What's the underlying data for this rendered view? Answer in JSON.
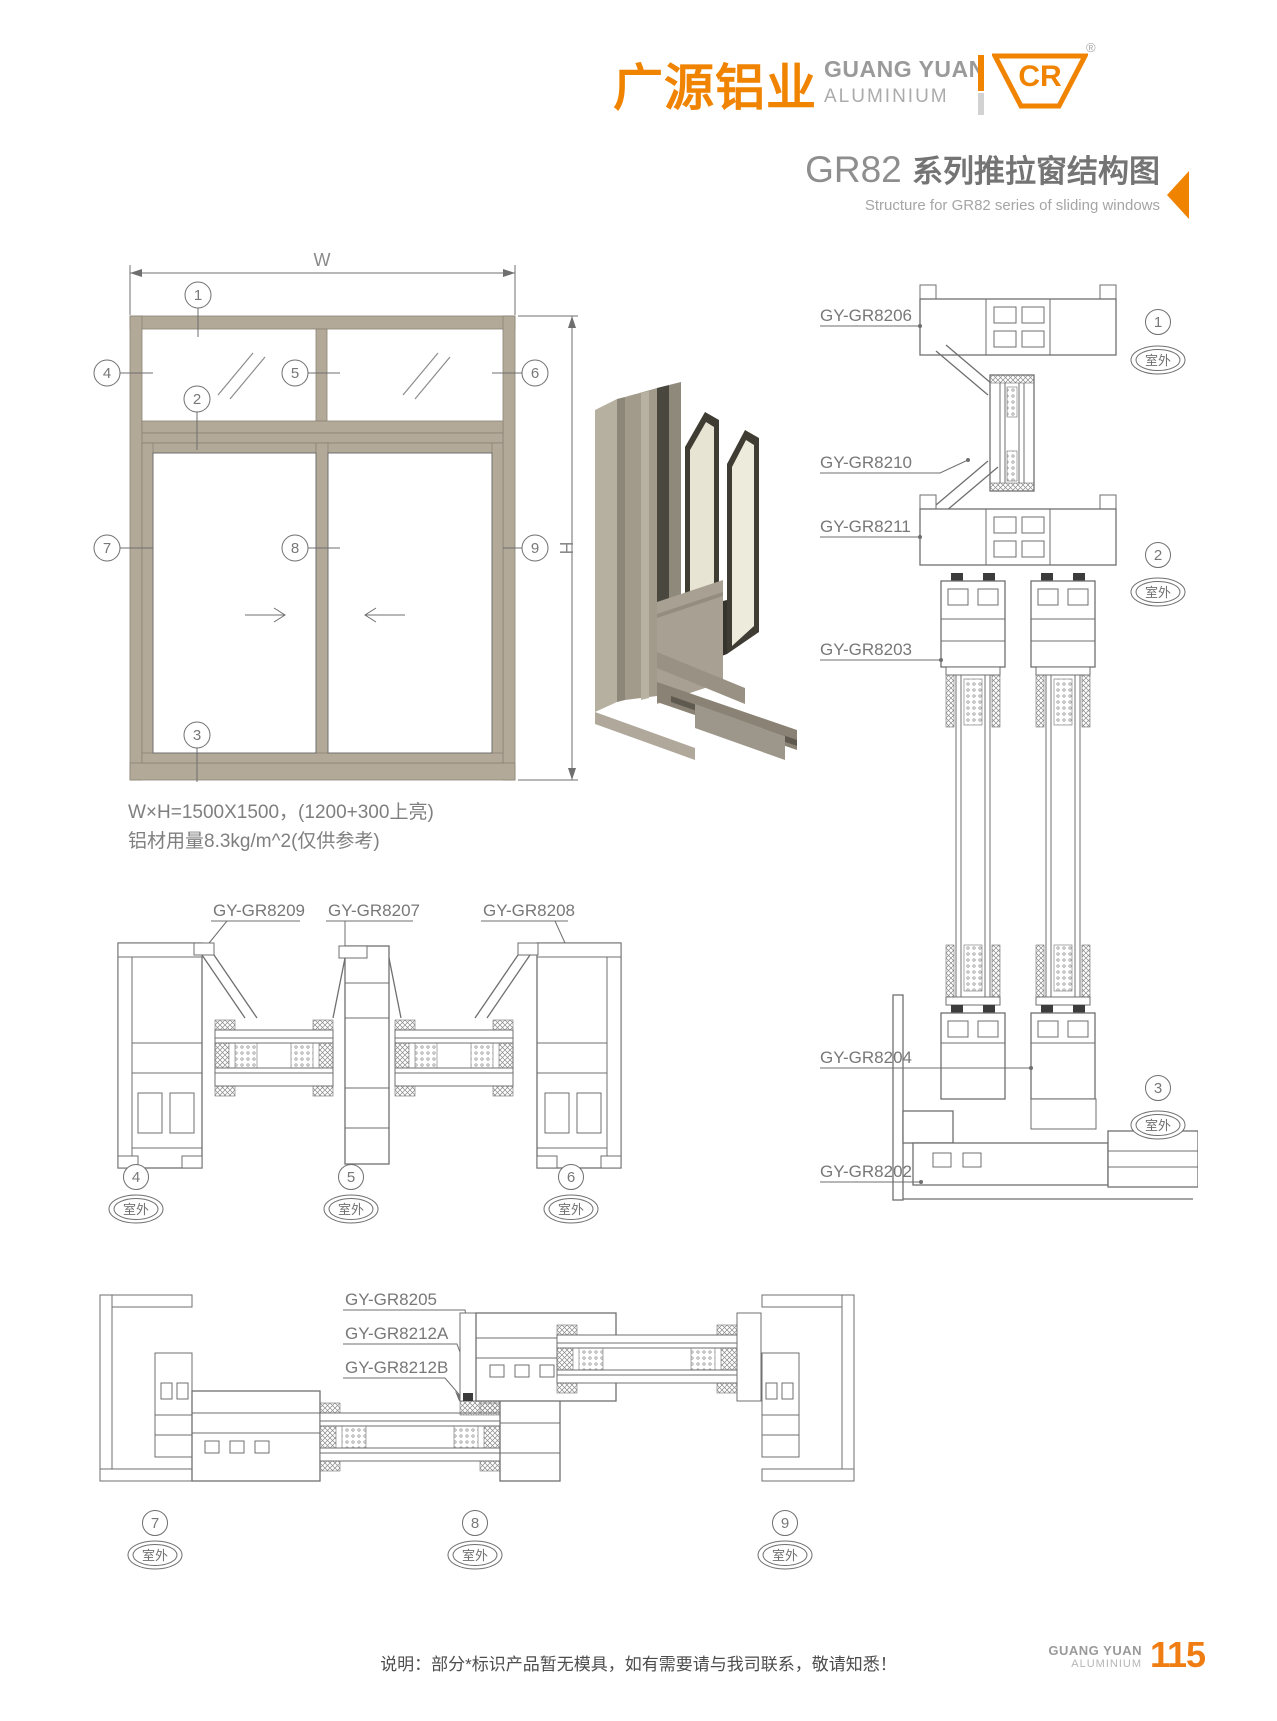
{
  "header": {
    "logo_cn": "广源铝业",
    "logo_en_line1": "GUANG YUAN",
    "logo_en_line2": "ALUMINIUM",
    "logo_mark": "CR",
    "registered_mark": "®"
  },
  "title": {
    "series": "GR82 ",
    "name_cn": "系列推拉窗结构图",
    "name_en": "Structure for GR82 series of sliding windows"
  },
  "elevation": {
    "width_label": "W",
    "height_label": "H",
    "callouts": [
      "1",
      "2",
      "3",
      "4",
      "5",
      "6",
      "7",
      "8",
      "9"
    ]
  },
  "specs": {
    "line1": "W×H=1500X1500，(1200+300上亮)",
    "line2": "铝材用量8.3kg/m^2(仅供参考)"
  },
  "vertical_section": {
    "labels": [
      "GY-GR8206",
      "GY-GR8210",
      "GY-GR8211",
      "GY-GR8203",
      "GY-GR8204",
      "GY-GR8202"
    ],
    "callouts": [
      {
        "num": "1",
        "location": "室外"
      },
      {
        "num": "2",
        "location": "室外"
      },
      {
        "num": "3",
        "location": "室外"
      }
    ]
  },
  "mid_section": {
    "labels": [
      "GY-GR8209",
      "GY-GR8207",
      "GY-GR8208"
    ],
    "callouts": [
      {
        "num": "4",
        "location": "室外"
      },
      {
        "num": "5",
        "location": "室外"
      },
      {
        "num": "6",
        "location": "室外"
      }
    ]
  },
  "bottom_section": {
    "labels": [
      "GY-GR8205",
      "GY-GR8212A",
      "GY-GR8212B"
    ],
    "callouts": [
      {
        "num": "7",
        "location": "室外"
      },
      {
        "num": "8",
        "location": "室外"
      },
      {
        "num": "9",
        "location": "室外"
      }
    ]
  },
  "footer": {
    "note": "说明：部分*标识产品暂无模具，如有需要请与我司联系，敬请知悉！",
    "brand_line1": "GUANG YUAN",
    "brand_line2": "ALUMINIUM",
    "page_number": "115"
  },
  "colors": {
    "accent": "#f08300",
    "frame_fill": "#b2a999",
    "line": "#6f6f6f"
  }
}
